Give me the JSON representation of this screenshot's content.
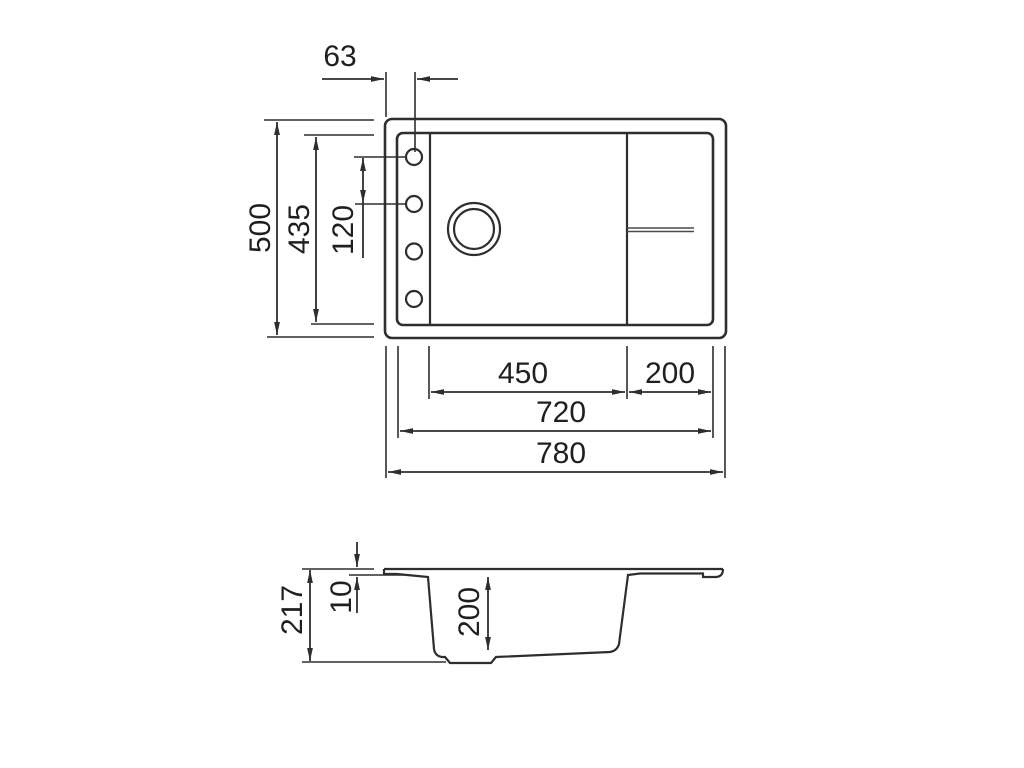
{
  "drawing": {
    "type": "technical-dimension-drawing",
    "subject": "kitchen sink with drainboard, top view and side section view",
    "line_color": "#2e2e2e",
    "background": "#ffffff",
    "top_view": {
      "dims": {
        "hole_offset": "63",
        "outer_height": "500",
        "inner_height": "435",
        "hole_spacing": "120",
        "bowl_width": "450",
        "drainer_width": "200",
        "inner_width": "720",
        "outer_width": "780"
      },
      "features": {
        "tap_holes_count": 4,
        "drain_hole": "double-ring circle",
        "drain_groove": "double line on drainboard"
      }
    },
    "side_view": {
      "dims": {
        "total_height": "217",
        "rim_thickness": "10",
        "bowl_depth": "200"
      }
    }
  }
}
